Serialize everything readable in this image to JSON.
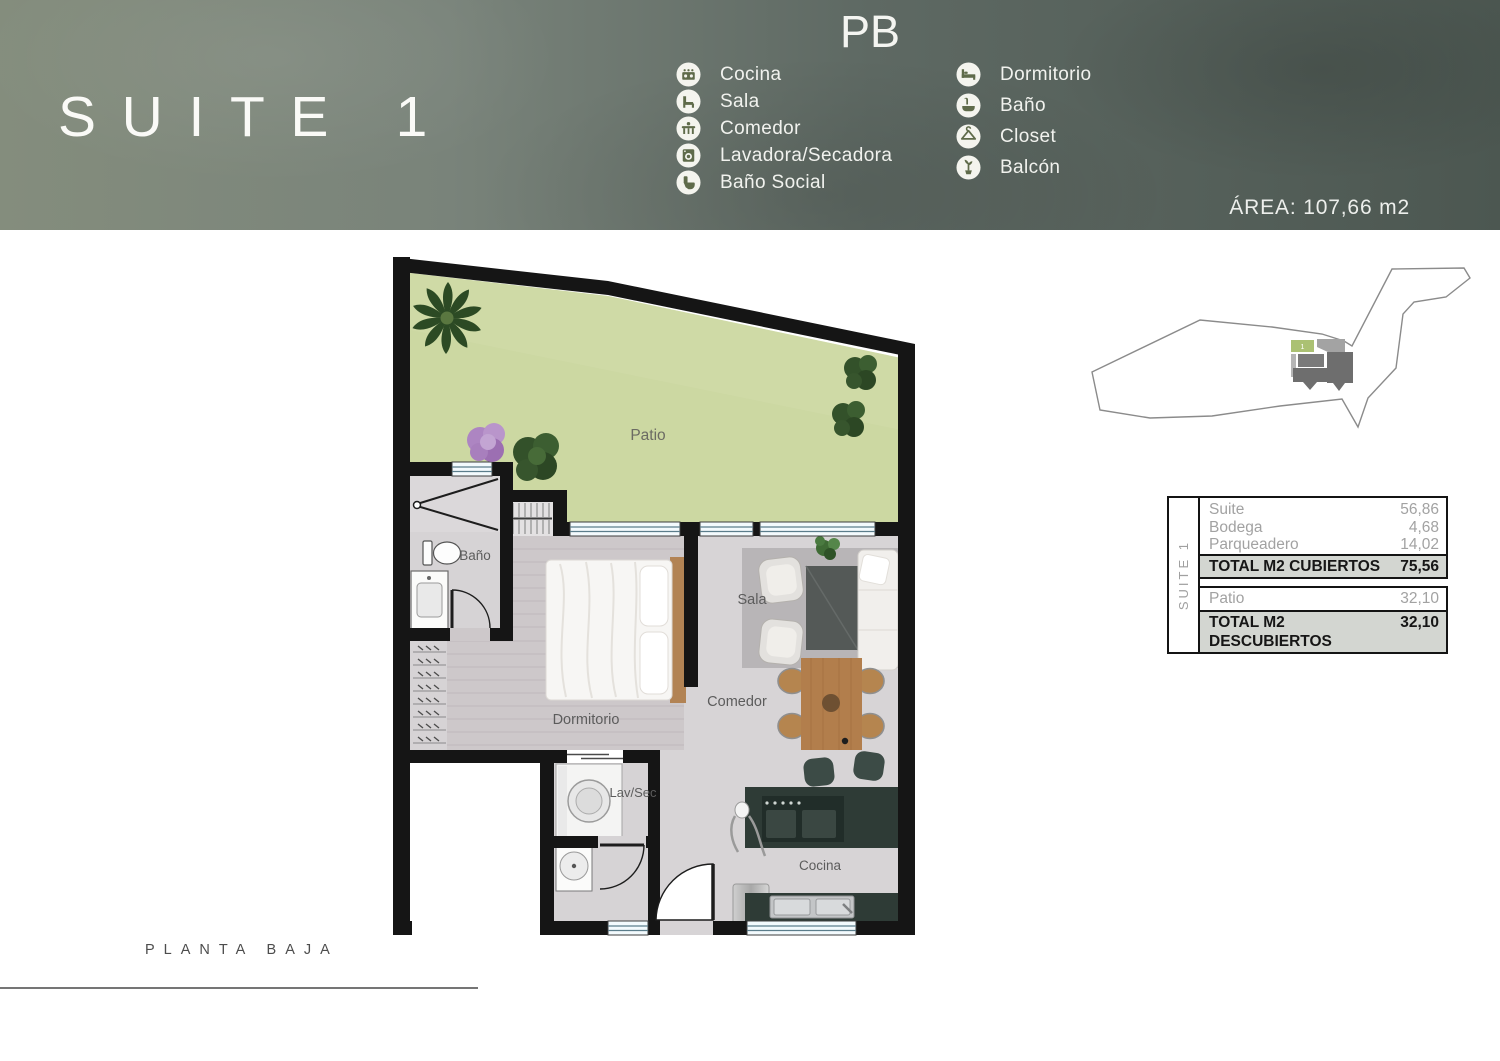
{
  "header": {
    "title": "SUITE 1",
    "floor_code": "PB",
    "area_label": "ÁREA: 107,66 m2",
    "bg_left_color": "#848d7d",
    "bg_right_color": "#4c5751",
    "icon_circle_color": "#f4f4ee",
    "icon_glyph_color": "#5f6b4a",
    "legend_left": [
      {
        "icon": "stove-icon",
        "label": "Cocina"
      },
      {
        "icon": "sofa-icon",
        "label": "Sala"
      },
      {
        "icon": "dining-table-icon",
        "label": "Comedor"
      },
      {
        "icon": "washer-icon",
        "label": "Lavadora/Secadora"
      },
      {
        "icon": "toilet-icon",
        "label": "Baño Social"
      }
    ],
    "legend_right": [
      {
        "icon": "bed-icon",
        "label": "Dormitorio"
      },
      {
        "icon": "bathtub-icon",
        "label": "Baño"
      },
      {
        "icon": "hanger-icon",
        "label": "Closet"
      },
      {
        "icon": "balcony-icon",
        "label": "Balcón"
      }
    ]
  },
  "plan": {
    "labels": {
      "patio": "Patio",
      "bano": "Baño",
      "dormitorio": "Dormitorio",
      "sala": "Sala",
      "comedor": "Comedor",
      "lavsec": "Lav/Sec",
      "cocina": "Cocina"
    },
    "colors": {
      "wall": "#151515",
      "patio_green": "#ccd8a2",
      "floor_gray": "#d7d4d6",
      "bedroom_floor": "#cdc8ca",
      "counter_dark": "#2e3b36",
      "wood": "#b27e4c"
    }
  },
  "site_map": {
    "unit_number": "1",
    "unit_color": "#abc173"
  },
  "areas_table": {
    "side_label": "SUITE 1",
    "covered": {
      "items": [
        {
          "label": "Suite",
          "value": "56,86"
        },
        {
          "label": "Bodega",
          "value": "4,68"
        },
        {
          "label": "Parqueadero",
          "value": "14,02"
        }
      ],
      "total_label": "TOTAL M2 CUBIERTOS",
      "total_value": "75,56"
    },
    "uncovered": {
      "items": [
        {
          "label": "Patio",
          "value": "32,10"
        }
      ],
      "total_label": "TOTAL M2 DESCUBIERTOS",
      "total_value": "32,10"
    }
  },
  "footer": {
    "plan_label": "PLANTA BAJA"
  }
}
